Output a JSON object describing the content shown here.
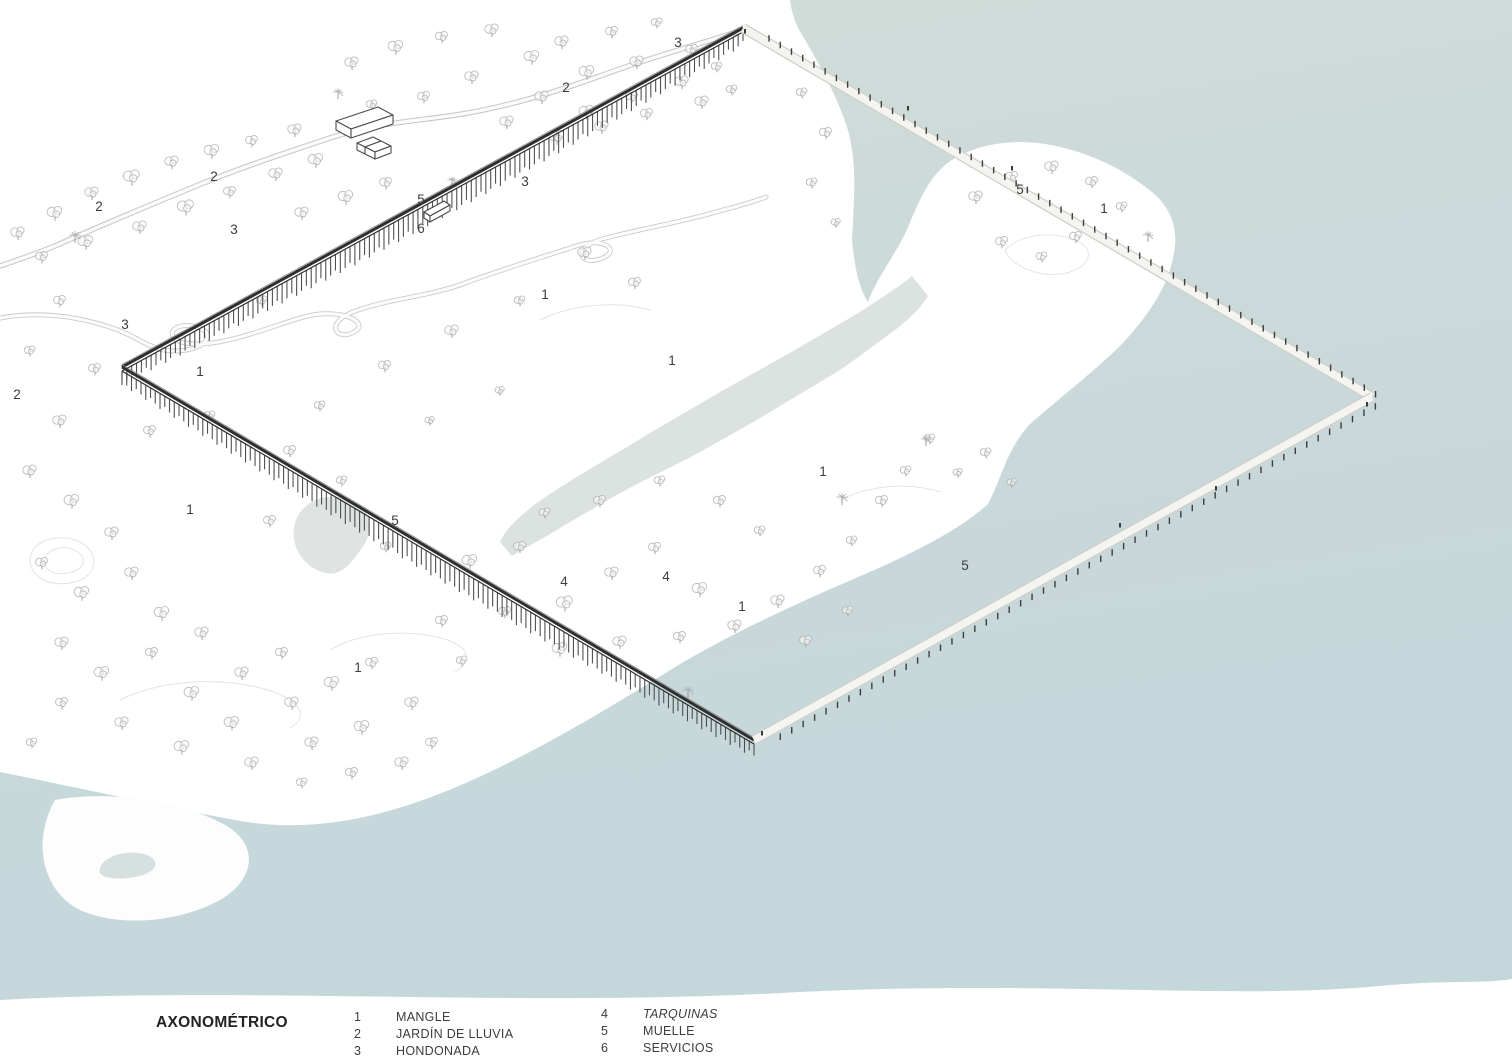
{
  "legend": {
    "title": "AXONOMÉTRICO",
    "columns": [
      {
        "items": [
          {
            "num": "1",
            "label": "MANGLE",
            "italic": false
          },
          {
            "num": "2",
            "label": "JARDÍN DE LLUVIA",
            "italic": false
          },
          {
            "num": "3",
            "label": "HONDONADA",
            "italic": false
          }
        ]
      },
      {
        "items": [
          {
            "num": "4",
            "label": "TARQUINAS",
            "italic": true
          },
          {
            "num": "5",
            "label": "MUELLE",
            "italic": false
          },
          {
            "num": "6",
            "label": "SERVICIOS",
            "italic": false
          }
        ]
      }
    ]
  },
  "colors": {
    "seaTop": "#d2ddd8",
    "seaMid": "#cbd9da",
    "seaBottom": "#c4d7db",
    "channel": "#dce2df",
    "pond": "#dde3e0",
    "pondSmall": "#d6e0de",
    "land": "#fdfdfd",
    "contour": "#e3e3e3",
    "roadOuter": "#c7c7c7",
    "roadInner": "#fbfbfb",
    "deck": "#2f2f2f",
    "post": "#474747",
    "rail": "#8a8a8a",
    "pierEdge": "#cfcfc9",
    "pierFill": "#f4f4f1",
    "tick": "#3d3d3d",
    "treeStroke": "#b2b2b2",
    "treeFill": "#fcfcfc",
    "trunk": "#9c9c9c",
    "building": "#4a4a4a",
    "label": "#3c3c3c",
    "figure": "#3a3a3a"
  },
  "scene": {
    "labelStyle": {
      "size": 13.5
    },
    "shapes": [
      {
        "name": "sea-water",
        "d": "M790,0 L1512,0 L1512,1002 L0,1002 L0,772 C80,788 160,806 235,820 C330,838 420,806 498,768 C560,738 622,700 680,664 C740,629 800,602 865,574 C918,551 962,528 988,504 C1002,478 1006,450 1030,424 C1062,396 1096,370 1122,344 C1146,318 1166,290 1172,262 C1180,234 1174,208 1148,189 C1118,165 1078,148 1038,143 C998,139 964,149 944,166 C924,184 916,210 904,236 C890,262 874,284 868,302 C858,287 854,262 852,240 C854,198 858,160 846,124 C834,88 812,52 798,28 C793,17 791,8 790,0 Z",
        "f": "url(#seaG)"
      },
      {
        "name": "estuary-channel",
        "d": "M912,276 C895,290 878,300 860,312 C838,325 817,337 795,350 C770,364 745,378 720,392 C695,407 670,421 645,436 C622,450 598,464 575,478 C558,489 541,499 528,510 C516,520 505,530 500,542 L512,556 C528,546 544,538 560,528 C580,516 601,504 622,492 C648,478 674,466 700,452 C723,439 747,426 770,412 C793,398 817,384 840,370 C859,357 877,343 895,330 C908,320 921,308 928,296 L912,276 Z",
        "f": "#dce2df"
      },
      {
        "name": "rain-pond",
        "d": "M296,520 C305,498 330,492 350,500 C372,508 375,530 362,548 C350,565 340,578 322,572 C300,565 288,540 296,520 Z",
        "f": "#dde3e0",
        "o": 0.95
      },
      {
        "name": "shore-islet",
        "d": "M55,800 C110,790 180,800 225,825 C260,845 255,880 220,900 C180,922 120,928 80,910 C45,893 30,845 55,800 Z",
        "f": "#fdfdfd"
      },
      {
        "name": "islet-pond",
        "d": "M100,868 C105,852 140,848 152,858 C162,866 150,876 128,878 C110,880 96,876 100,868 Z",
        "f": "#d6e0de"
      },
      {
        "name": "contour",
        "d": "M30,560 C30,540 60,532 80,542 C100,552 98,576 75,582 C52,588 30,578 30,560 Z",
        "s": "#e3e3e3",
        "w": 1
      },
      {
        "name": "contour",
        "d": "M45,558 C48,548 66,544 78,552 C88,559 84,570 68,573 C52,576 42,568 45,558 Z",
        "s": "#e3e3e3",
        "w": 1
      },
      {
        "name": "contour",
        "d": "M120,700 C160,680 220,676 268,690 C300,700 310,716 290,728",
        "s": "#e3e3e3",
        "w": 1
      },
      {
        "name": "contour",
        "d": "M330,650 C360,632 410,628 448,640 C470,648 472,662 455,672",
        "s": "#e3e3e3",
        "w": 1
      },
      {
        "name": "contour",
        "d": "M1005,250 C1020,235 1050,230 1075,240 C1095,248 1092,265 1070,272 C1045,280 1012,268 1005,250 Z",
        "s": "#e6e6e6",
        "w": 1
      },
      {
        "name": "contour",
        "d": "M840,500 C870,485 910,482 940,492",
        "s": "#e3e3e3",
        "w": 1
      },
      {
        "name": "contour",
        "d": "M540,320 C570,305 615,300 650,310",
        "s": "#e3e3e3",
        "w": 1
      },
      {
        "name": "upper-road",
        "d": "M743,30 C700,44 648,58 600,76 C556,92 510,106 462,114 C420,121 378,122 330,138 C282,154 240,168 196,186 C150,205 100,226 55,246 C30,256 12,262 0,266",
        "s": "#c7c7c7",
        "w": 5.5
      },
      {
        "name": "upper-road",
        "d": "M743,30 C700,44 648,58 600,76 C556,92 510,106 462,114 C420,121 378,122 330,138 C282,154 240,168 196,186 C150,205 100,226 55,246 C30,256 12,262 0,266",
        "s": "#fbfbfb",
        "w": 3.4
      },
      {
        "name": "serpentine-path",
        "d": "M0,318 C45,310 85,318 118,330 C142,339 152,352 178,351 C210,349 218,330 192,326 C168,322 162,344 196,344 C228,344 262,330 300,318 C338,306 372,322 354,332 C336,342 322,322 358,310 C394,298 432,296 468,282 C506,268 540,258 576,246 C606,236 622,252 600,259 C578,266 572,246 606,238 C640,229 682,222 716,212 C738,206 754,202 766,197",
        "s": "#cbcbcb",
        "w": 5
      },
      {
        "name": "serpentine-path",
        "d": "M0,318 C45,310 85,318 118,330 C142,339 152,352 178,351 C210,349 218,330 192,326 C168,322 162,344 196,344 C228,344 262,330 300,318 C338,306 372,322 354,332 C336,342 322,322 358,310 C394,298 432,296 468,282 C506,268 540,258 576,246 C606,236 622,252 600,259 C578,266 572,246 606,238 C640,229 682,222 716,212 C738,206 754,202 766,197",
        "s": "#fbfbfb",
        "w": 3.2
      }
    ],
    "buildings": [
      "M336,121 L378,107 L393,115 L351,129 Z",
      "M336,121 L336,130 L351,138 L351,129 Z",
      "M351,129 L393,115 L393,124 L351,138 Z",
      "M357,143 L373,137 L381,141 L365,147 Z",
      "M365,147 L381,141 L391,146 L375,152 Z",
      "M357,143 L357,150 L365,154 L365,147 Z",
      "M365,147 L365,154 L375,159 L375,152 Z",
      "M375,152 L391,146 L391,153 L375,159 Z",
      "M424,212 L444,201 L450,205 L430,216 Z",
      "M424,212 L424,218 L430,222 L430,216 Z",
      "M430,216 L450,205 L450,211 L430,222 Z"
    ],
    "boardwalk": {
      "dark": [
        {
          "x1": 743,
          "y1": 28,
          "x2": 122,
          "y2": 367
        },
        {
          "x1": 122,
          "y1": 367,
          "x2": 754,
          "y2": 740
        }
      ],
      "light": [
        {
          "x1": 743,
          "y1": 28,
          "x2": 1372,
          "y2": 397,
          "side": "up"
        },
        {
          "x1": 754,
          "y1": 740,
          "x2": 1372,
          "y2": 397,
          "side": "down"
        }
      ]
    },
    "figures": [
      [
        762,
        733
      ],
      [
        1120,
        525
      ],
      [
        1216,
        488
      ],
      [
        1012,
        168
      ],
      [
        908,
        108
      ],
      [
        1367,
        404
      ],
      [
        745,
        31
      ]
    ],
    "labels": [
      [
        678,
        47,
        "3"
      ],
      [
        566,
        92,
        "2"
      ],
      [
        214,
        181,
        "2"
      ],
      [
        99,
        211,
        "2"
      ],
      [
        525,
        186,
        "3"
      ],
      [
        421,
        204,
        "5"
      ],
      [
        421,
        233,
        "6"
      ],
      [
        234,
        234,
        "3"
      ],
      [
        1020,
        194,
        "5"
      ],
      [
        1104,
        213,
        "1"
      ],
      [
        125,
        329,
        "3"
      ],
      [
        200,
        376,
        "1"
      ],
      [
        17,
        399,
        "2"
      ],
      [
        545,
        299,
        "1"
      ],
      [
        672,
        365,
        "1"
      ],
      [
        823,
        476,
        "1"
      ],
      [
        190,
        514,
        "1"
      ],
      [
        395,
        525,
        "5"
      ],
      [
        965,
        570,
        "5"
      ],
      [
        564,
        586,
        "4"
      ],
      [
        666,
        581,
        "4"
      ],
      [
        742,
        611,
        "1"
      ],
      [
        358,
        672,
        "1"
      ]
    ],
    "trees": [
      [
        18,
        232,
        1
      ],
      [
        55,
        212,
        1.1
      ],
      [
        92,
        192,
        1
      ],
      [
        132,
        176,
        1.2
      ],
      [
        172,
        161,
        1
      ],
      [
        212,
        150,
        1.1
      ],
      [
        252,
        140,
        0.9
      ],
      [
        295,
        129,
        1
      ],
      [
        42,
        256,
        0.9
      ],
      [
        86,
        241,
        1.1
      ],
      [
        140,
        226,
        1
      ],
      [
        186,
        206,
        1.2
      ],
      [
        230,
        191,
        0.9
      ],
      [
        276,
        173,
        1
      ],
      [
        316,
        159,
        1.1
      ],
      [
        352,
        62,
        1
      ],
      [
        396,
        46,
        1.1
      ],
      [
        442,
        36,
        0.9
      ],
      [
        492,
        29,
        1
      ],
      [
        532,
        56,
        1.1
      ],
      [
        472,
        76,
        1
      ],
      [
        424,
        96,
        0.9
      ],
      [
        372,
        104,
        0.8
      ],
      [
        562,
        41,
        1
      ],
      [
        612,
        31,
        0.9
      ],
      [
        657,
        22,
        0.8
      ],
      [
        587,
        71,
        1.1
      ],
      [
        637,
        61,
        1
      ],
      [
        692,
        49,
        0.9
      ],
      [
        542,
        96,
        1
      ],
      [
        587,
        111,
        1.1
      ],
      [
        632,
        96,
        0.9
      ],
      [
        682,
        81,
        1
      ],
      [
        717,
        66,
        0.8
      ],
      [
        507,
        121,
        1
      ],
      [
        557,
        136,
        1.1
      ],
      [
        602,
        126,
        1
      ],
      [
        647,
        113,
        0.9
      ],
      [
        702,
        101,
        1
      ],
      [
        732,
        89,
        0.8
      ],
      [
        302,
        212,
        1
      ],
      [
        346,
        196,
        1.1
      ],
      [
        386,
        182,
        0.9
      ],
      [
        262,
        300,
        0.8
      ],
      [
        60,
        300,
        0.9
      ],
      [
        30,
        350,
        0.8
      ],
      [
        95,
        368,
        0.9
      ],
      [
        60,
        420,
        1
      ],
      [
        150,
        430,
        0.9
      ],
      [
        210,
        415,
        0.8
      ],
      [
        585,
        252,
        1
      ],
      [
        635,
        282,
        0.9
      ],
      [
        520,
        300,
        0.8
      ],
      [
        452,
        330,
        1
      ],
      [
        385,
        365,
        0.9
      ],
      [
        320,
        405,
        0.8
      ],
      [
        290,
        450,
        0.9
      ],
      [
        430,
        420,
        0.7
      ],
      [
        500,
        390,
        0.7
      ],
      [
        470,
        560,
        1.1
      ],
      [
        520,
        546,
        0.9
      ],
      [
        565,
        602,
        1.2
      ],
      [
        612,
        572,
        1
      ],
      [
        655,
        547,
        0.9
      ],
      [
        700,
        588,
        1.1
      ],
      [
        735,
        625,
        1
      ],
      [
        680,
        636,
        0.9
      ],
      [
        620,
        641,
        1
      ],
      [
        560,
        648,
        1.1
      ],
      [
        505,
        611,
        0.9
      ],
      [
        545,
        512,
        0.8
      ],
      [
        600,
        500,
        0.9
      ],
      [
        660,
        480,
        0.8
      ],
      [
        720,
        500,
        0.9
      ],
      [
        760,
        530,
        0.8
      ],
      [
        778,
        600,
        1
      ],
      [
        820,
        570,
        0.9
      ],
      [
        852,
        540,
        0.8
      ],
      [
        882,
        500,
        0.9
      ],
      [
        906,
        470,
        0.8
      ],
      [
        930,
        438,
        0.8
      ],
      [
        806,
        640,
        0.9
      ],
      [
        848,
        610,
        0.8
      ],
      [
        30,
        470,
        1
      ],
      [
        72,
        500,
        1.1
      ],
      [
        112,
        532,
        1
      ],
      [
        42,
        562,
        0.9
      ],
      [
        82,
        592,
        1.1
      ],
      [
        132,
        572,
        1
      ],
      [
        162,
        612,
        1.1
      ],
      [
        62,
        642,
        1
      ],
      [
        102,
        672,
        1.1
      ],
      [
        152,
        652,
        0.9
      ],
      [
        202,
        632,
        1
      ],
      [
        192,
        692,
        1.1
      ],
      [
        242,
        672,
        1
      ],
      [
        282,
        652,
        0.9
      ],
      [
        232,
        722,
        1.1
      ],
      [
        292,
        702,
        1
      ],
      [
        332,
        682,
        1.1
      ],
      [
        372,
        662,
        0.9
      ],
      [
        312,
        742,
        1
      ],
      [
        362,
        726,
        1.1
      ],
      [
        412,
        702,
        1
      ],
      [
        432,
        742,
        0.9
      ],
      [
        252,
        762,
        1
      ],
      [
        182,
        746,
        1.1
      ],
      [
        122,
        722,
        1
      ],
      [
        62,
        702,
        0.9
      ],
      [
        32,
        742,
        0.8
      ],
      [
        402,
        762,
        1
      ],
      [
        352,
        772,
        0.9
      ],
      [
        302,
        782,
        0.8
      ],
      [
        270,
        520,
        0.9
      ],
      [
        386,
        546,
        0.8
      ],
      [
        342,
        480,
        0.8
      ],
      [
        442,
        620,
        0.9
      ],
      [
        462,
        660,
        0.8
      ],
      [
        976,
        196,
        1
      ],
      [
        1012,
        176,
        0.9
      ],
      [
        1052,
        166,
        1
      ],
      [
        1092,
        181,
        0.9
      ],
      [
        1122,
        206,
        0.8
      ],
      [
        1002,
        241,
        0.9
      ],
      [
        1042,
        256,
        0.8
      ],
      [
        1076,
        236,
        0.9
      ],
      [
        986,
        452,
        0.8
      ],
      [
        1012,
        482,
        0.7
      ],
      [
        958,
        472,
        0.7
      ],
      [
        802,
        92,
        0.8
      ],
      [
        826,
        132,
        0.9
      ],
      [
        812,
        182,
        0.8
      ],
      [
        836,
        222,
        0.7
      ]
    ],
    "palms": [
      [
        75,
        243,
        1
      ],
      [
        338,
        99,
        0.9
      ],
      [
        842,
        505,
        1
      ],
      [
        926,
        446,
        0.9
      ],
      [
        688,
        698,
        1
      ],
      [
        1148,
        242,
        0.9
      ],
      [
        452,
        186,
        0.8
      ]
    ],
    "fade": "M0,1064 L0,1000 C250,986 520,1008 800,992 C1050,980 1230,1000 1380,986 C1440,980 1480,984 1512,979 L1512,1064 Z"
  }
}
